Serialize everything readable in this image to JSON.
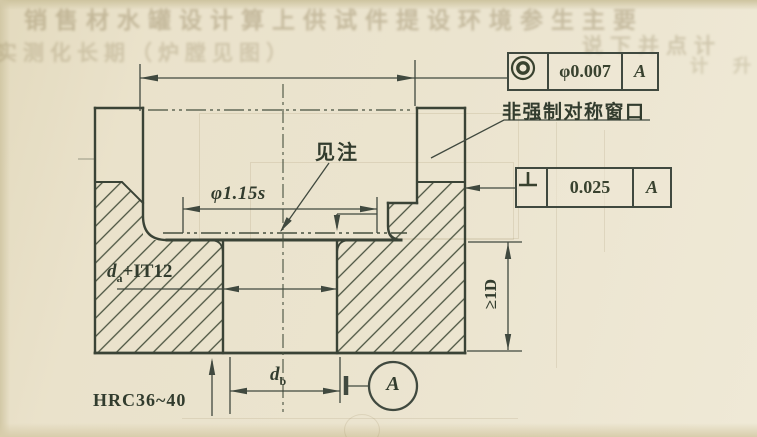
{
  "page": {
    "bleedthrough": {
      "line1": "销售材水罐设计算上供试件提设环境参生主要",
      "line2_left": "实测化长期（炉膛见图）",
      "line2_right": "说下并点计",
      "margin_right": "计 升"
    },
    "frames": {
      "concentricity": {
        "symbol_name": "concentricity",
        "tolerance": "φ0.007",
        "datum": "A"
      },
      "perpendicularity": {
        "symbol_name": "perpendicularity",
        "tolerance": "0.025",
        "datum": "A"
      }
    },
    "labels": {
      "window_note": "非强制对称窗口",
      "see_note": "见注",
      "ring_diameter": "φ1.15s",
      "hole_diameter": {
        "base": "d",
        "sub": "a",
        "suffix": "+IT12"
      },
      "hardness": "HRC36~40",
      "bottom_diameter": {
        "base": "d",
        "sub": "b"
      },
      "min_depth": "≥1D",
      "datum_circle": "A"
    },
    "colors": {
      "paper": "#e9e1ca",
      "ink": "#40493f",
      "ghost": "#8d7f5c"
    }
  }
}
